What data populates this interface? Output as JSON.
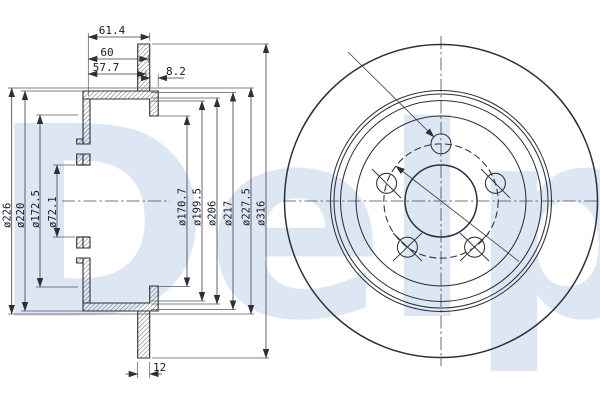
{
  "watermark": "Delphi",
  "section_view": {
    "top_dims": {
      "total_depth": "61.4",
      "mid_depth": "60",
      "inner_depth": "57.7",
      "wall_step": "8.2"
    },
    "left_diameters": {
      "d1": "ø226",
      "d2": "ø220",
      "d3": "ø172.5",
      "d4": "ø72.1"
    },
    "right_diameters": {
      "d1": "ø170.7",
      "d2": "ø199.5",
      "d3": "ø206",
      "d4": "ø217",
      "d5": "ø227.5",
      "d6": "ø316"
    },
    "disc_thickness": "12"
  },
  "front_view": {
    "bolt_hole_count": 5
  }
}
